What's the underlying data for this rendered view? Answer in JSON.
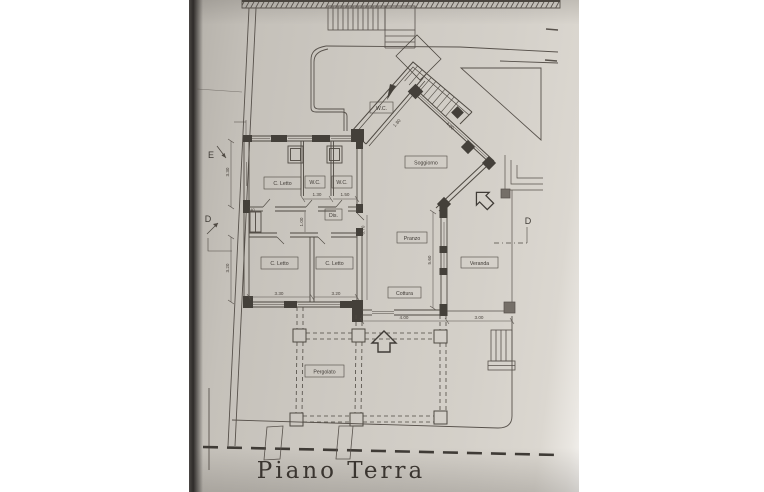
{
  "title": {
    "label": "Piano Terra"
  },
  "plan": {
    "rooms": {
      "soggiorno": "Soggiorno",
      "wc_entrance": "W.C.",
      "c_letto_top": "C. Letto",
      "wc_1": "W.C.",
      "wc_2": "W.C.",
      "dis": "Dis.",
      "c_letto_left": "C. Letto",
      "c_letto_mid": "C. Letto",
      "pranzo": "Pranzo",
      "cottura": "Cottura",
      "veranda": "Veranda",
      "pergolato": "Pergolato"
    },
    "dimensions": {
      "wc1_width": "1.30",
      "wc2_width": "1.50",
      "corridor_width": "1.00",
      "corridor_small": ".40",
      "bed_left_width": "3.30",
      "bed_mid_width": "3.20",
      "side_upper": "3.30",
      "side_lower": "3.20",
      "kitchen_width": "4.00",
      "veranda_width": "3.00",
      "right_wall_height": "5.60",
      "center_height": "6.70",
      "entry_diagonal": "1.80",
      "stair_diagonal": "4.00"
    },
    "markers": {
      "section_e": "E",
      "section_d_left": "D",
      "section_d_right": "D"
    }
  },
  "colors": {
    "paper": "#cdc9c2",
    "ink": "#57514b",
    "ink_dark": "#44403a"
  }
}
